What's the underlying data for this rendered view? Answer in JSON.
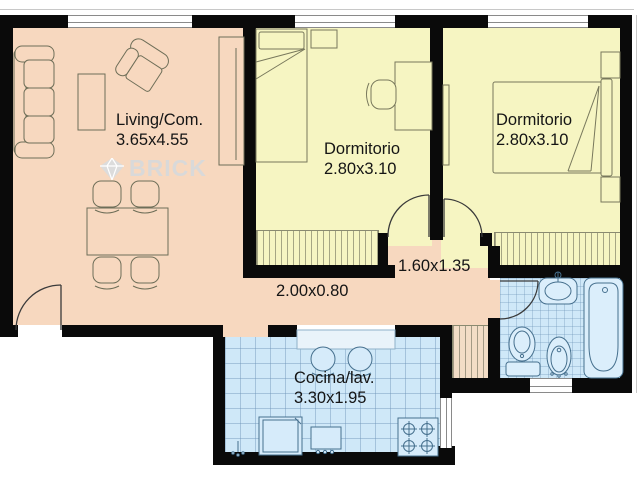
{
  "plan_title": "apartment floor plan",
  "rooms": {
    "living": {
      "label": "Living/Com.",
      "dims": "3.65x4.55"
    },
    "bedroom1": {
      "label": "Dormitorio",
      "dims": "2.80x3.10"
    },
    "bedroom2": {
      "label": "Dormitorio",
      "dims": "2.80x3.10"
    },
    "hall": {
      "dims": "1.60x1.35"
    },
    "corridor": {
      "dims": "2.00x0.80"
    },
    "kitchen": {
      "label": "Cocina/lav.",
      "dims": "3.30x1.95"
    }
  },
  "watermark": {
    "brand": "BRICK",
    "icon": "gem-icon"
  },
  "colors": {
    "wall": "#0a0a0a",
    "living": "#f7d8bf",
    "bedroom": "#f6f5c2",
    "wet": "#cfe8f8",
    "furniture_stroke": "#6e6e58",
    "fixture_stroke": "#46708e",
    "watermark_gray": "#d9d9d9"
  },
  "furniture": {
    "living": [
      "sofa",
      "armchair",
      "sideboard",
      "tv-unit",
      "dining-table",
      "dining-chair x4"
    ],
    "bedroom1": [
      "single-bed",
      "nightstand",
      "desk",
      "desk-chair",
      "built-in-closet"
    ],
    "bedroom2": [
      "double-bed",
      "nightstand x2",
      "wall-shelf",
      "built-in-closet"
    ],
    "hall": [
      "hall-closet"
    ],
    "kitchen": [
      "breakfast-counter",
      "stool x2",
      "washing-machine",
      "laundry-sink",
      "stove",
      "floor-drain"
    ],
    "bathroom": [
      "sink-vanity",
      "bathtub",
      "toilet",
      "bidet"
    ]
  }
}
